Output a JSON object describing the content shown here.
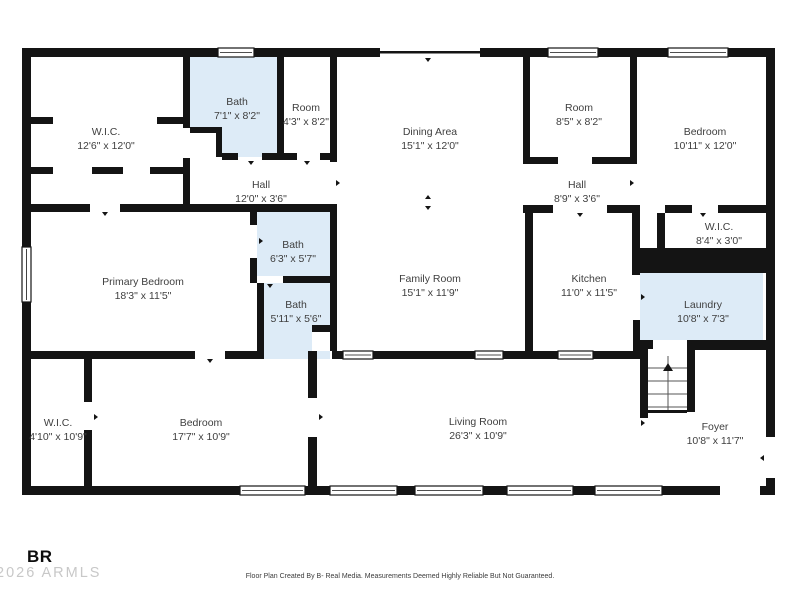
{
  "colors": {
    "wall": "#141414",
    "bath": "#ddebf7",
    "label": "#3f3f3f",
    "watermark": "#c8c8c8",
    "disclaimer": "#3c3c3c",
    "logo": "#0d0d0d"
  },
  "rooms": [
    {
      "name": "W.I.C.",
      "dims": "12'6\" x 12'0\""
    },
    {
      "name": "Bath",
      "dims": "7'1\" x 8'2\""
    },
    {
      "name": "Room",
      "dims": "4'3\" x 8'2\""
    },
    {
      "name": "Dining Area",
      "dims": "15'1\" x 12'0\""
    },
    {
      "name": "Room",
      "dims": "8'5\" x 8'2\""
    },
    {
      "name": "Bedroom",
      "dims": "10'11\" x 12'0\""
    },
    {
      "name": "Hall",
      "dims": "12'0\" x 3'6\""
    },
    {
      "name": "Hall",
      "dims": "8'9\" x 3'6\""
    },
    {
      "name": "Primary Bedroom",
      "dims": "18'3\" x 11'5\""
    },
    {
      "name": "Bath",
      "dims": "6'3\" x 5'7\""
    },
    {
      "name": "Family Room",
      "dims": "15'1\" x 11'9\""
    },
    {
      "name": "Kitchen",
      "dims": "11'0\" x 11'5\""
    },
    {
      "name": "W.I.C.",
      "dims": "8'4\" x 3'0\""
    },
    {
      "name": "Bath",
      "dims": "5'11\" x 5'6\""
    },
    {
      "name": "Laundry",
      "dims": "10'8\" x 7'3\""
    },
    {
      "name": "W.I.C.",
      "dims": "4'10\" x 10'9\""
    },
    {
      "name": "Bedroom",
      "dims": "17'7\" x 10'9\""
    },
    {
      "name": "Living Room",
      "dims": "26'3\" x 10'9\""
    },
    {
      "name": "Foyer",
      "dims": "10'8\" x 11'7\""
    }
  ],
  "footer": {
    "logo_text": "BR",
    "watermark": "2026 ARMLS",
    "disclaimer": "Floor Plan Created By B- Real Media. Measurements Deemed Highly Reliable But Not Guaranteed."
  }
}
